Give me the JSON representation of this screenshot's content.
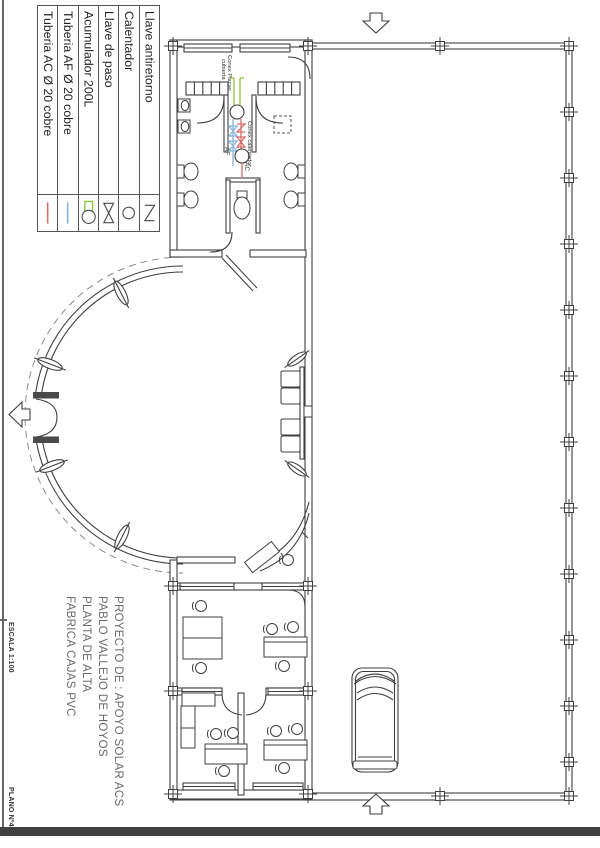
{
  "legend": {
    "items": [
      {
        "label": "Tuberia AC Ø 20 cobre",
        "symbol": "hot-water-pipe",
        "color": "#d96b6b"
      },
      {
        "label": "Tuberia AF Ø 20 cobre",
        "symbol": "cold-water-pipe",
        "color": "#8fb8dc"
      },
      {
        "label": "Acumulador 200L",
        "symbol": "accumulator",
        "color": "#8cc63f"
      },
      {
        "label": "Llave de paso",
        "symbol": "shutoff-valve"
      },
      {
        "label": "Calentador",
        "symbol": "heater"
      },
      {
        "label": "Llave antiretorno",
        "symbol": "check-valve"
      }
    ]
  },
  "title_block": {
    "lines": [
      "PROYECTO DE : APOYO SOLAR ACS",
      "PABLO VALLEJO DE HOYOS",
      "PLANTA DE ALTA",
      "FABRICA CAJAS PVC"
    ]
  },
  "margin": {
    "scale": "ESCALA 1:100",
    "plan_number": "PLANO Nº4"
  },
  "plan": {
    "annotations": {
      "roof_connection_line1": "Conex Placas",
      "roof_connection_line2": "cubierta",
      "heater_connection": "Conex calentador",
      "cold_water": "AF",
      "hot_water": "AC"
    }
  },
  "colors": {
    "linework": "#3f3f3f",
    "hot_pipe": "#d96b6b",
    "cold_pipe": "#8fb8dc",
    "solar_connection": "#8cc63f"
  }
}
